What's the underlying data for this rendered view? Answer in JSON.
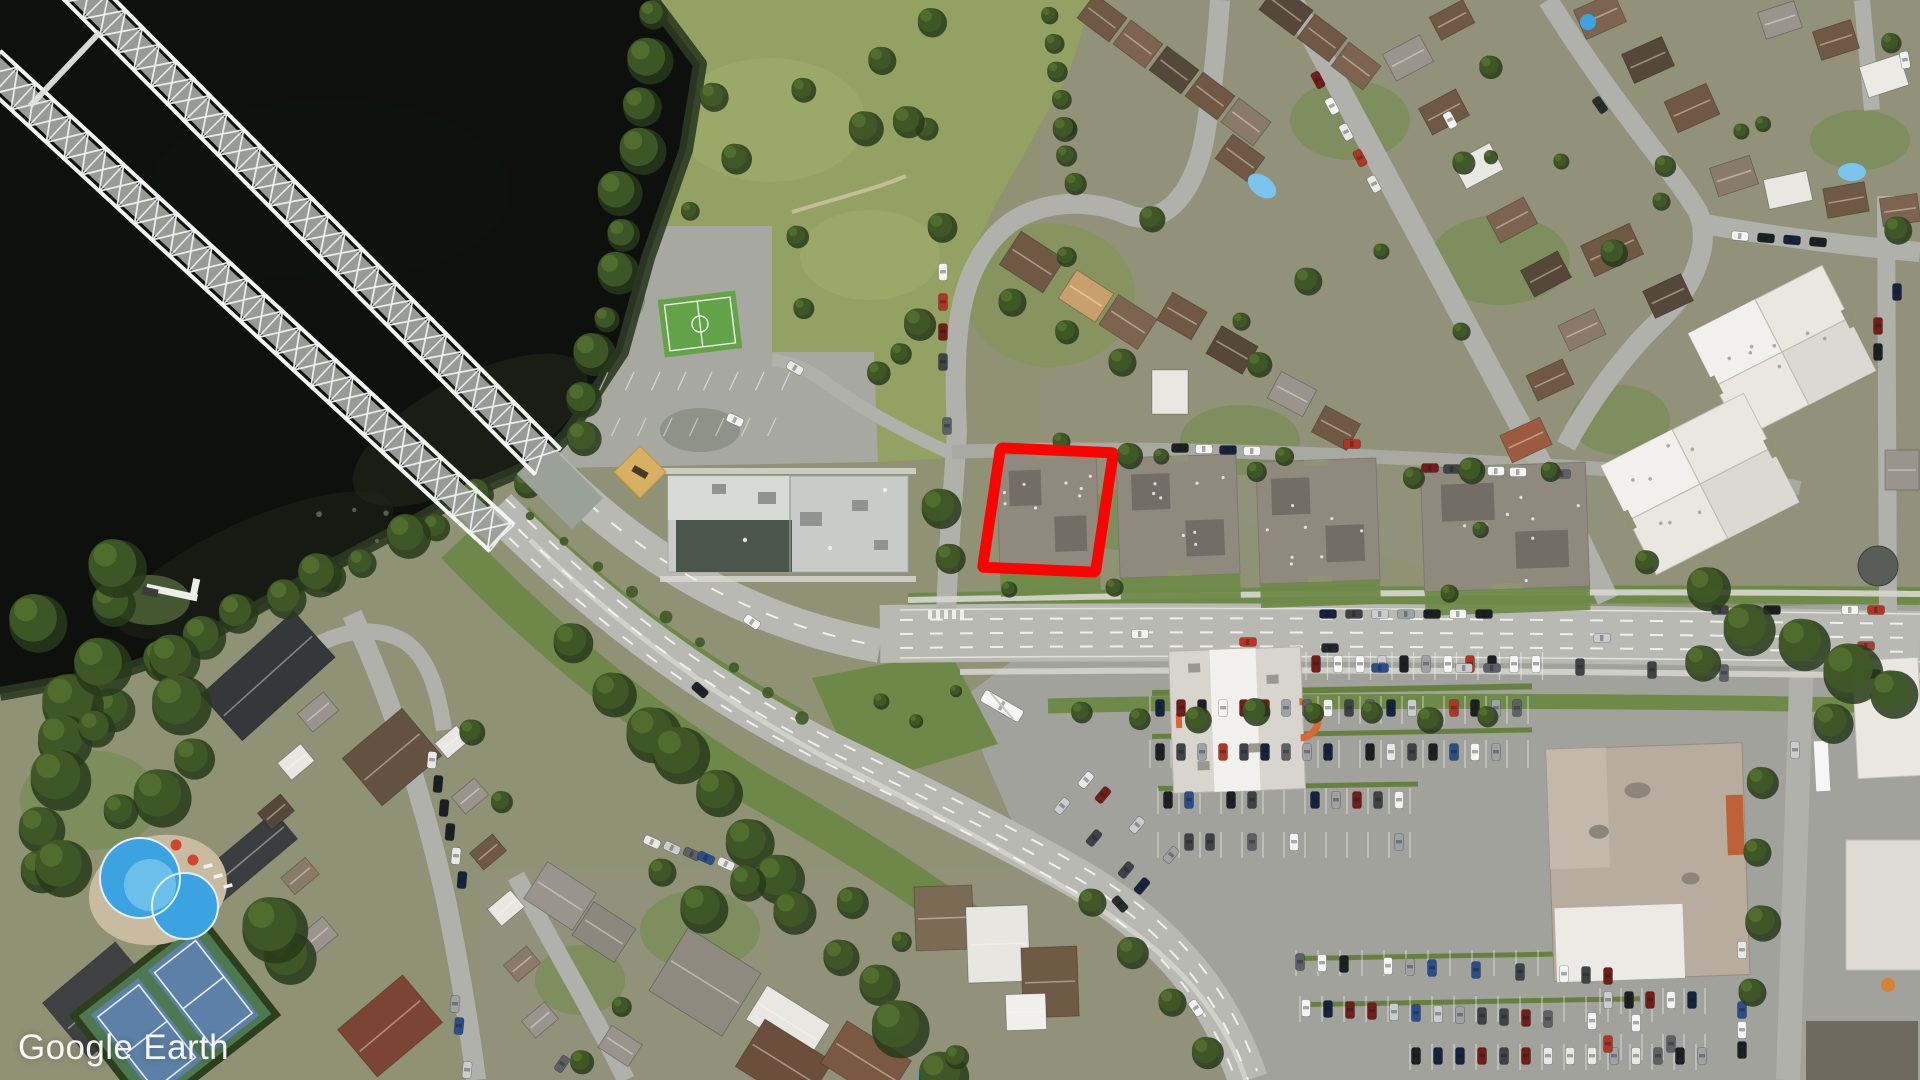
{
  "app": {
    "name": "Google Earth",
    "view": "satellite-aerial-imagery"
  },
  "watermark": {
    "text": "Google Earth",
    "color": "#ffffff",
    "position": "bottom-left"
  },
  "annotation": {
    "label": "highlighted-building-outline",
    "shape": "rectangle",
    "stroke_color": "#fa0400",
    "stroke_width": 11,
    "fill": "none",
    "center_x": 1048,
    "center_y": 510,
    "width": 113,
    "height": 120,
    "rotation_deg": 2.5,
    "skew_x_deg": -6
  },
  "palette": {
    "base_land": "#8f9274",
    "water": "#0d100d",
    "water_shallow": "#26291b",
    "park_grass": "#93a262",
    "park_light": "#a3af6e",
    "lawn_green": "#6e8a49",
    "verge_green": "#6d8847",
    "tree_dark": "#273a1b",
    "tree_mid": "#3f5926",
    "tree_light": "#52702f",
    "road_major": "#b8b9b3",
    "road_minor": "#b0b1aa",
    "asphalt_lot": "#a0a29b",
    "yard_paving": "#a7a8a0",
    "sidewalk": "#d7d7d0",
    "lane_marking": "#f4f4f0",
    "bridge_steel": "#eef1f0",
    "bridge_deck": "#9da09b",
    "school_roof": "#c8cbc7",
    "school_roof_light": "#d8dad7",
    "school_roof_dark": "#4a564c",
    "apartment_roof": "#8f897e",
    "apartment_roof_dark": "#6e6960",
    "white_roof": "#e9e7e0",
    "white_roof_bright": "#f1f0ec",
    "plaza_roof": "#b7ac9e",
    "orange_accent": "#d8682f",
    "pool_blue": "#3ca3e2",
    "pool_blue_light": "#79c5ee",
    "teal_pool": "#45b8c9",
    "tennis_court": "#5d80a8",
    "tennis_surround": "#4d7850",
    "soccer_green": "#63a348",
    "sand": "#d9b062",
    "house_brown": "#6f5844",
    "house_brown2": "#7d6450",
    "house_brown_dark": "#55483a",
    "house_tan": "#8a7b68",
    "house_gray": "#9a948c",
    "house_white": "#e9e7e1",
    "house_red_brown": "#7c4434",
    "dark_roof": "#34383b"
  },
  "features": [
    {
      "name": "river",
      "type": "water"
    },
    {
      "name": "steel-truss-bridge",
      "type": "bridge",
      "spans": 2
    },
    {
      "name": "park-green-space",
      "type": "park"
    },
    {
      "name": "soccer-field",
      "type": "sports-field"
    },
    {
      "name": "playground",
      "type": "playground"
    },
    {
      "name": "school-building",
      "type": "building"
    },
    {
      "name": "apartment-blocks-row",
      "type": "buildings"
    },
    {
      "name": "highlighted-building",
      "type": "building",
      "highlighted": true
    },
    {
      "name": "residential-crescent",
      "type": "street"
    },
    {
      "name": "main-boulevard",
      "type": "road"
    },
    {
      "name": "shopping-plaza",
      "type": "buildings"
    },
    {
      "name": "plaza-parking-lot",
      "type": "parking"
    },
    {
      "name": "outdoor-swimming-pool",
      "type": "pool"
    },
    {
      "name": "tennis-courts",
      "type": "sports-field"
    },
    {
      "name": "boat-dock",
      "type": "dock"
    }
  ]
}
